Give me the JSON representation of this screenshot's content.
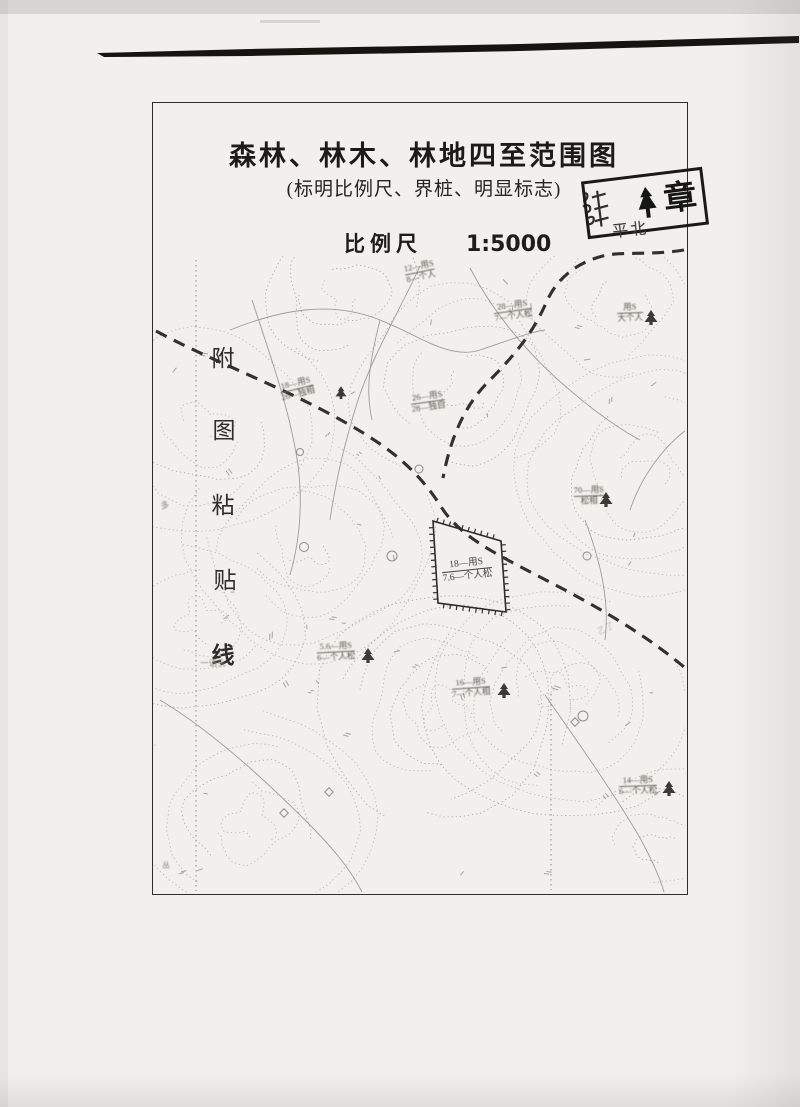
{
  "page": {
    "title": "森林、林木、林地四至范围图",
    "subtitle": "(标明比例尺、界桩、明显标志)",
    "scale_label": "比例尺",
    "scale_value": "1:5000"
  },
  "stamp": {
    "char": "章",
    "tree_icon": "spruce-tree-icon",
    "handwriting": "平北"
  },
  "paste_line": {
    "chars": [
      "附",
      "图",
      "粘",
      "贴",
      "线"
    ]
  },
  "map": {
    "parcel_label": {
      "top": "18—用S",
      "bottom": "7.6—个人松"
    },
    "labels": [
      {
        "top": "18—用S",
        "bottom": "26—独相"
      },
      {
        "top": "26—用S",
        "bottom": "28—独自"
      },
      {
        "top": "28—用S",
        "bottom": "7—个人松"
      },
      {
        "top": "用S",
        "bottom": "大个人"
      },
      {
        "top": "12—用S",
        "bottom": "8—个人"
      },
      {
        "top": "70—用S",
        "bottom": "松相"
      },
      {
        "top": "5.6—用S",
        "bottom": "6—个人松"
      },
      {
        "top": "16—用S",
        "bottom": "7—个人相"
      },
      {
        "top": "14—用S",
        "bottom": "6—个人松"
      },
      {
        "top": "一语头"
      },
      {
        "top": "多"
      },
      {
        "top": "乙了"
      },
      {
        "top": "丛"
      }
    ],
    "colors": {
      "paper": "#f1f0ec",
      "frame": "#2e2d2b",
      "contour": "#b4aea4",
      "road": "#23221e",
      "ink": "#1c1b19"
    }
  }
}
